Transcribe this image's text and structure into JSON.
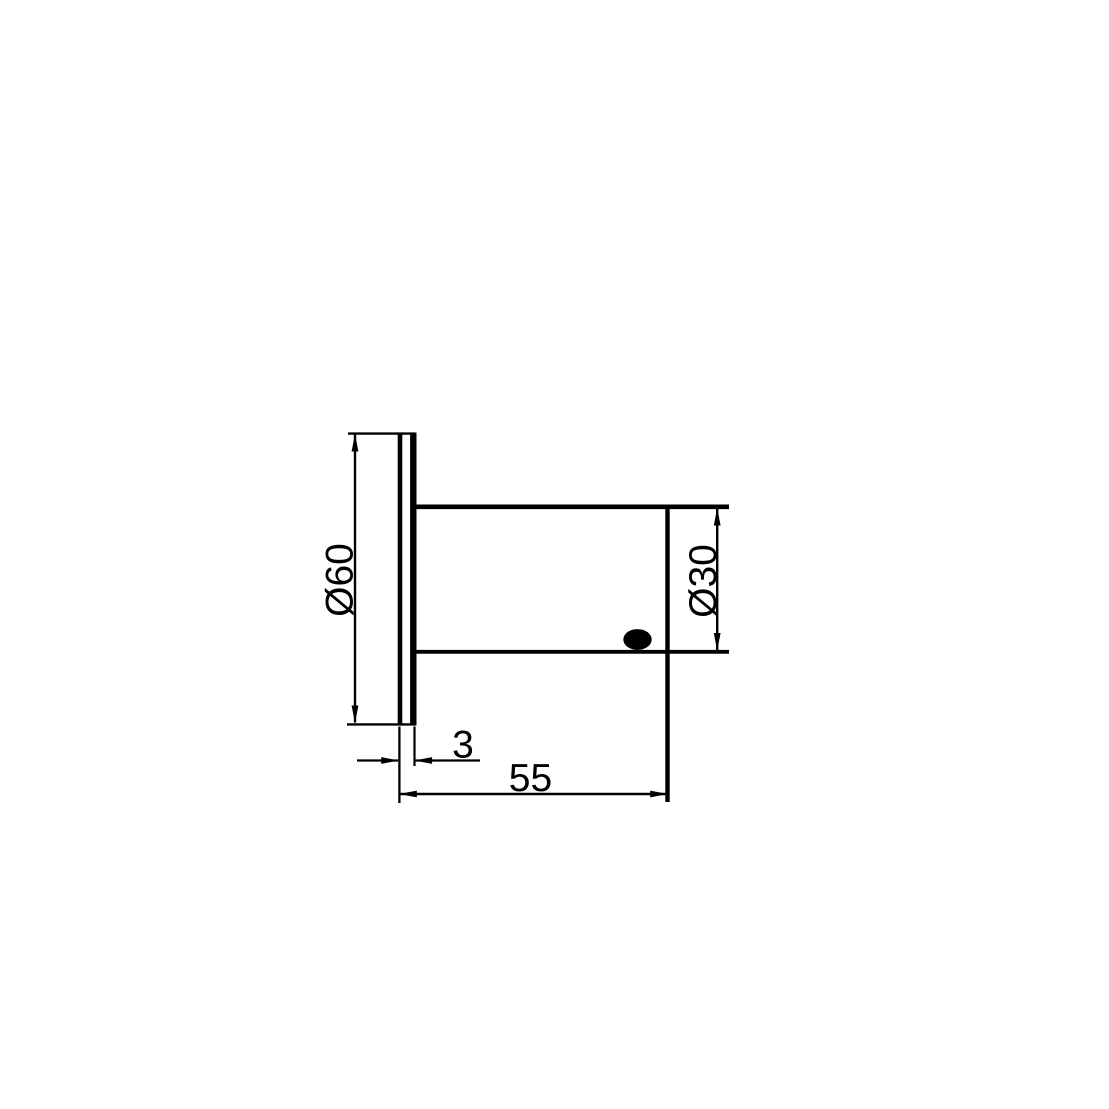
{
  "drawing": {
    "background_color": "#ffffff",
    "ink_color": "#000000",
    "labels": {
      "flange_diameter": "Ø60",
      "body_diameter": "Ø30",
      "flange_thickness": "3",
      "overall_length": "55"
    }
  }
}
